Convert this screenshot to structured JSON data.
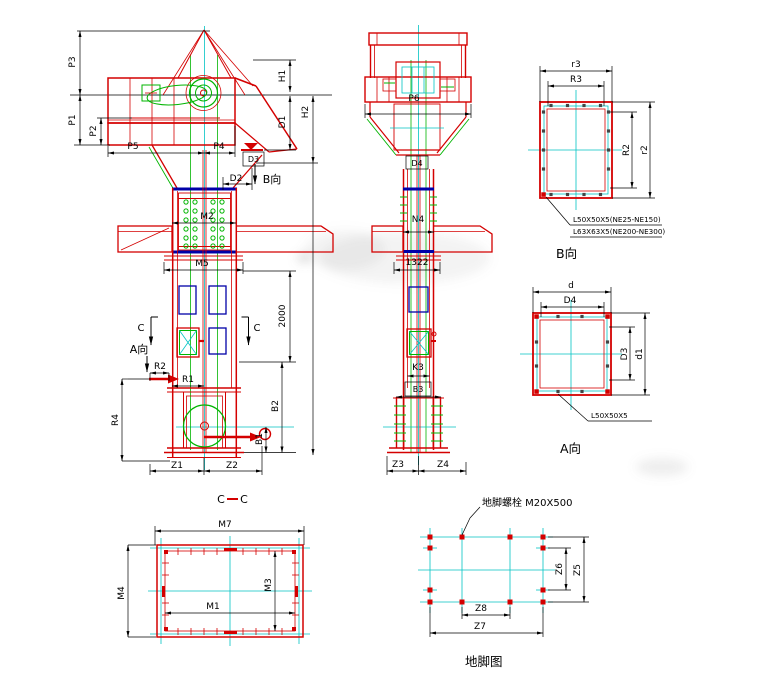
{
  "colors": {
    "line_red": "#d40000",
    "line_green": "#00b400",
    "line_cyan": "#00c3c3",
    "line_blue": "#0000a8",
    "dim_black": "#000000",
    "background": "#ffffff"
  },
  "left_view": {
    "p3": "P3",
    "p1": "P1",
    "p2": "P2",
    "p5": "P5",
    "p4": "P4",
    "h1": "H1",
    "d1": "D1",
    "h2": "H2",
    "d3": "D3",
    "d2": "D2",
    "b_dir": "B向",
    "m2": "M2",
    "m5": "M5",
    "dim_2000": "2000",
    "c_mark_left": "C",
    "c_mark_right": "C",
    "a_dir": "A向",
    "r2": "R2",
    "r1": "R1",
    "r4": "R4",
    "b2": "B2",
    "b1": "B1",
    "z1": "Z1",
    "z2": "Z2"
  },
  "front_view": {
    "p6": "P6",
    "d4": "D4",
    "n4": "N4",
    "dim_1322": "1322",
    "k3": "K3",
    "b3": "B3",
    "z3": "Z3",
    "z4": "Z4"
  },
  "detail_b": {
    "dim_r3_lower": "r3",
    "dim_r3_upper": "R3",
    "dim_r2_upper": "R2",
    "dim_r2_lower": "r2",
    "note_line1": "L50X50X5(NE25-NE150)",
    "note_line2": "L63X63X5(NE200-NE300)",
    "title": "B向"
  },
  "detail_a": {
    "dim_d": "d",
    "dim_d4": "D4",
    "dim_d3": "D3",
    "dim_d1": "d1",
    "note": "L50X50X5",
    "title": "A向"
  },
  "section_cc": {
    "title_c_left": "C",
    "title_c_right": "C",
    "m7": "M7",
    "m4": "M4",
    "m3": "M3",
    "m1": "M1"
  },
  "foundation": {
    "note": "地脚螺栓 M20X500",
    "z6": "Z6",
    "z5": "Z5",
    "z8": "Z8",
    "z7": "Z7",
    "title": "地脚图"
  }
}
